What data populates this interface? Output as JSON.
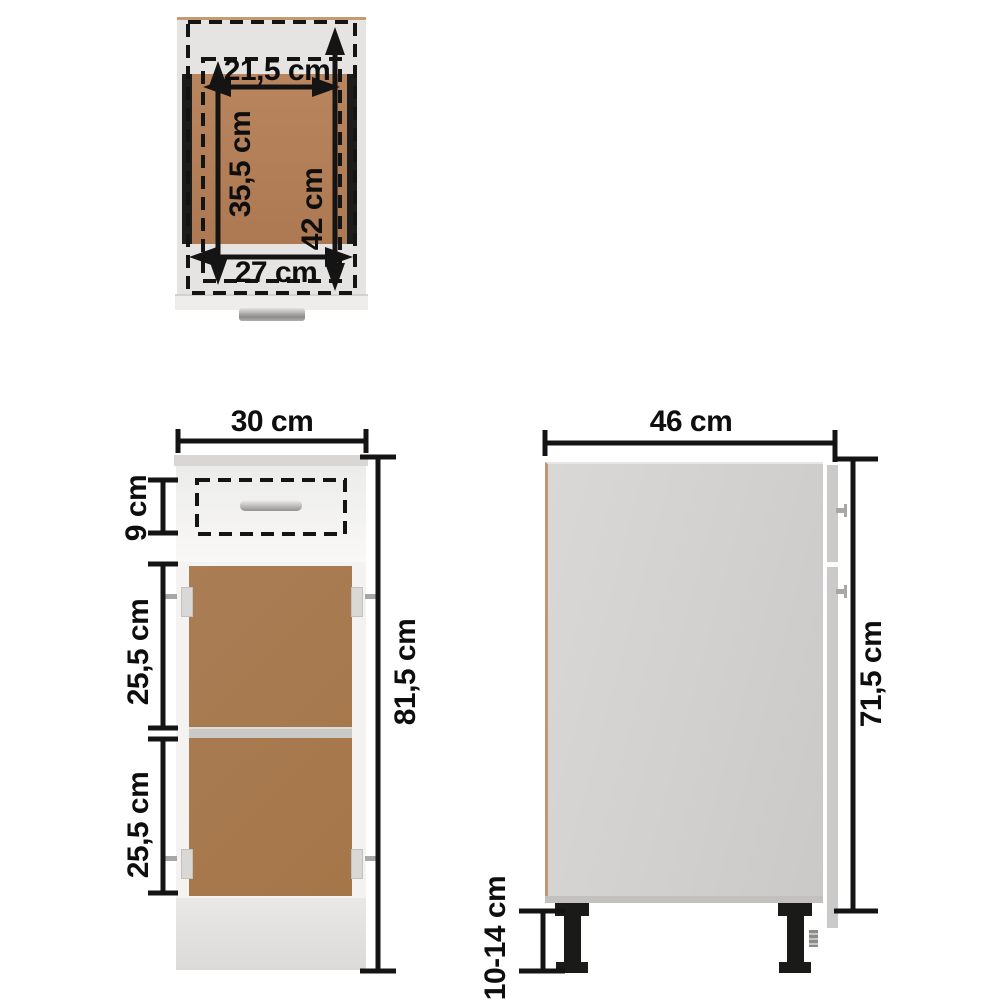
{
  "title": "Kitchen base cabinet dimension diagram (top, front and side views)",
  "labels": {
    "top_view": {
      "drawer_inner_width": "21,5 cm",
      "drawer_inner_depth": "35,5 cm",
      "drawer_outer_depth": "42 cm",
      "drawer_outer_width": "27 cm"
    },
    "front_view": {
      "width": "30 cm",
      "drawer_height": "9 cm",
      "upper_compartment_height": "25,5 cm",
      "lower_compartment_height": "25,5 cm",
      "total_height": "81,5 cm"
    },
    "side_view": {
      "depth": "46 cm",
      "body_height": "71,5 cm",
      "leg_height": "10-14 cm"
    }
  },
  "colors": {
    "dimension_ink": "#121212",
    "cabinet_white": "#f7f6f5",
    "wood_brown": "#a87a52",
    "top_wood_brown": "#b17d56",
    "side_panel_gray": "#d3d1d0",
    "edge_tan": "#c49a72",
    "leg_black": "#1a1a19"
  }
}
